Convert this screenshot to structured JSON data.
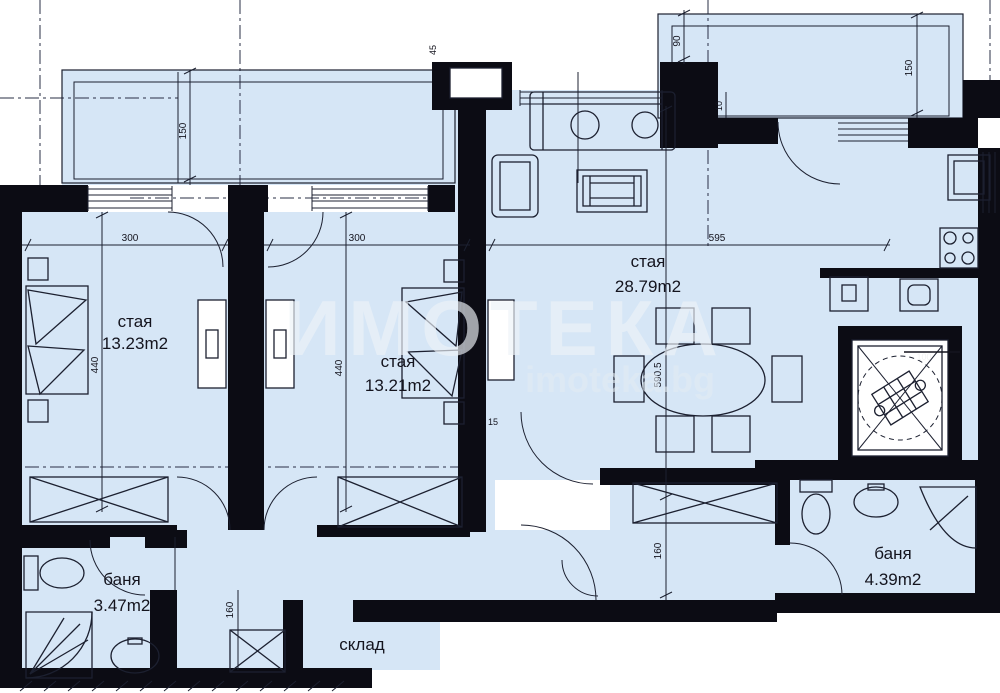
{
  "watermark": {
    "brand": "ИМОТЕКА",
    "site": "imoteka.bg"
  },
  "rooms": [
    {
      "name": "стая",
      "area": "13.23m2"
    },
    {
      "name": "стая",
      "area": "13.21m2"
    },
    {
      "name": "стая",
      "area": "28.79m2"
    },
    {
      "name": "баня",
      "area": "3.47m2"
    },
    {
      "name": "баня",
      "area": "4.39m2"
    },
    {
      "name": "склад",
      "area": ""
    }
  ],
  "dimensions": {
    "balcony_left_depth": "150",
    "balcony_right_depth": "150",
    "entry_width": "90",
    "entry_offset": "10",
    "bedroom_left_width": "300",
    "bedroom_middle_width": "300",
    "living_width": "595",
    "bedroom_left_depth": "440",
    "bedroom_middle_depth": "440",
    "living_depth": "590.5",
    "corridor_depth": "160",
    "storage_width": "160",
    "elevator_width": "100",
    "wall_niche": "15",
    "column_offset": "45"
  },
  "colors": {
    "floor": "#d6e6f6",
    "wall": "#0c0c14",
    "line": "#1c2030",
    "watermark": "#eef3f8"
  }
}
